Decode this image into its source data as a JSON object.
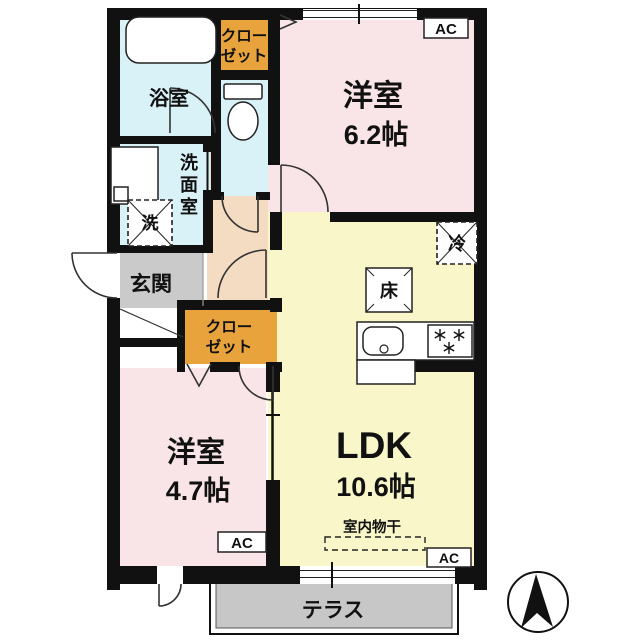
{
  "plan": {
    "rooms": {
      "western_6_2": {
        "name": "洋室",
        "area": "6.2帖"
      },
      "ldk": {
        "name": "LDK",
        "area": "10.6帖"
      },
      "western_4_7": {
        "name": "洋室",
        "area": "4.7帖"
      },
      "bathroom": "浴室",
      "washroom_chars": [
        "洗",
        "面",
        "室"
      ],
      "entrance": "玄関",
      "terrace": "テラス"
    },
    "closets": {
      "top": [
        "クロー",
        "ゼット"
      ],
      "middle": [
        "クロー",
        "ゼット"
      ]
    },
    "equipment": {
      "ac": "AC",
      "refrigerator": "冷",
      "floor_storage": "床",
      "washing_machine": "洗",
      "indoor_clothes_drying": "室内物干"
    },
    "colors": {
      "wall": "#111111",
      "western_room": "#f9e5e7",
      "ldk": "#f9f7c9",
      "wet_area": "#d8f2f7",
      "hallway": "#f4dcc2",
      "closet": "#e8a33c",
      "entrance": "#cacaca",
      "terrace": "#c7c7c7"
    }
  }
}
